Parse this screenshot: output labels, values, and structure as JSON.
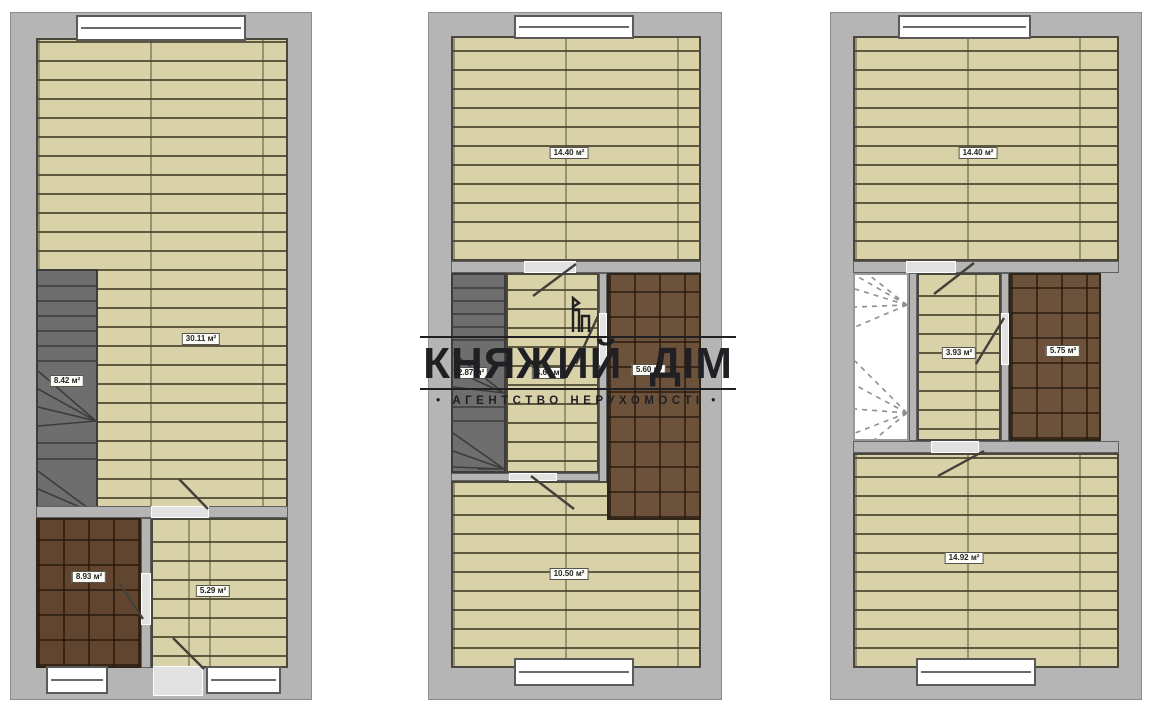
{
  "watermark": {
    "title": "КНЯЖИЙ ДІМ",
    "subtitle": "• АГЕНТСТВО НЕРУХОМОСТІ •",
    "logo_icon": "castle-tower-icon"
  },
  "colors": {
    "wall": "#b5b5b5",
    "plank_floor": "#d9d1a8",
    "tile_floor": "#6d523b",
    "stairs": "#6e6e6e",
    "watermark_text": "#1f1f24"
  },
  "plans": [
    {
      "name": "first-floor-plan",
      "rooms": {
        "living": "30.11 м²",
        "stairs": "8.42 м²",
        "bathroom": "8.93 м²",
        "hall": "5.29 м²"
      }
    },
    {
      "name": "second-floor-plan",
      "rooms": {
        "bedroom_top": "14.40 м²",
        "stairs": "2.87 м²",
        "hall": "4.67 м²",
        "bathroom": "5.60 м²",
        "bedroom_bottom": "10.50 м²"
      }
    },
    {
      "name": "third-floor-plan",
      "rooms": {
        "bedroom_top": "14.40 м²",
        "hall": "3.93 м²",
        "bathroom": "5.75 м²",
        "bedroom_bottom": "14.92 м²"
      }
    }
  ]
}
